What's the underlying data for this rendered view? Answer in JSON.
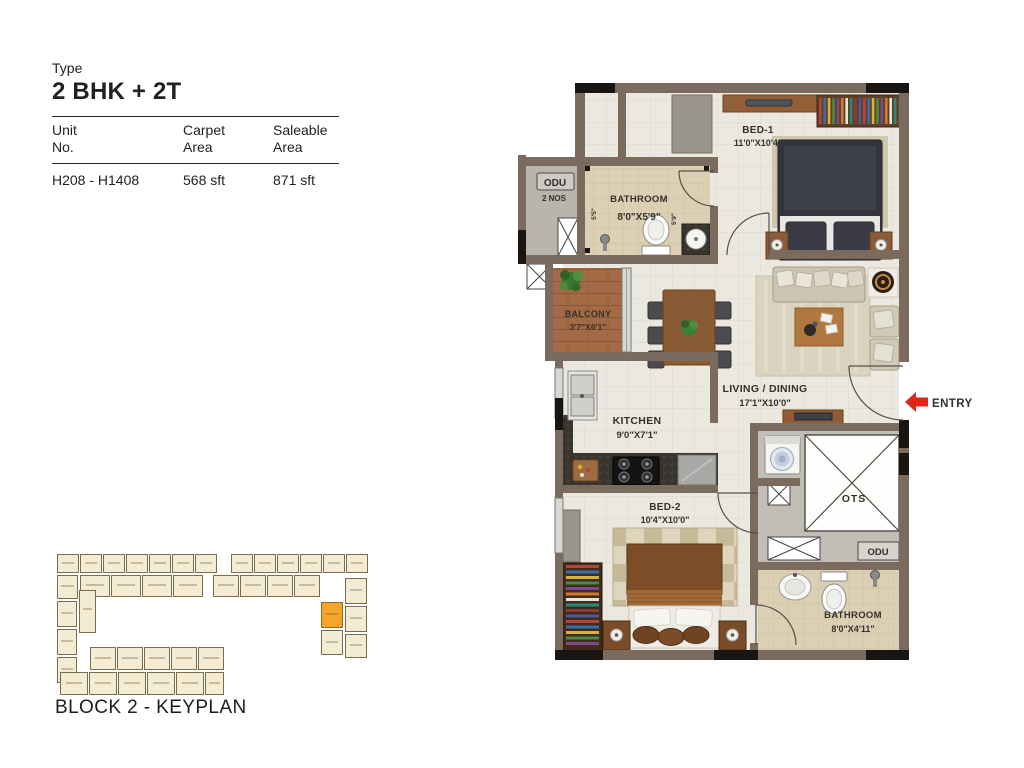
{
  "header": {
    "type_label": "Type",
    "type_value": "2 BHK + 2T",
    "table": {
      "columns": [
        {
          "line1": "Unit",
          "line2": "No."
        },
        {
          "line1": "Carpet",
          "line2": "Area"
        },
        {
          "line1": "Saleable",
          "line2": "Area"
        }
      ],
      "row": {
        "unit_no": "H208 - H1408",
        "carpet_area": "568 sft",
        "saleable_area": "871 sft"
      }
    }
  },
  "floorplan": {
    "rooms": {
      "bed1": {
        "name": "BED-1",
        "dim": "11'0\"X10'4\""
      },
      "bathroom1": {
        "name": "BATHROOM",
        "dim": "8'0\"X5'9\""
      },
      "odu_top": {
        "name": "ODU",
        "qty": "2 NOS"
      },
      "balcony": {
        "name": "BALCONY",
        "dim": "3'7\"X6'1\""
      },
      "living_dining": {
        "name": "LIVING / DINING",
        "dim": "17'1\"X10'0\""
      },
      "kitchen": {
        "name": "KITCHEN",
        "dim": "9'0\"X7'1\""
      },
      "bed2": {
        "name": "BED-2",
        "dim": "10'4\"X10'0\""
      },
      "ots": {
        "name": "OTS"
      },
      "odu_bottom": {
        "name": "ODU"
      },
      "bathroom2": {
        "name": "BATHROOM",
        "dim": "8'0\"X4'11\""
      }
    },
    "small_dims": {
      "bathroom1_left": "5'5\"",
      "bathroom1_right": "5'9\""
    },
    "entry_label": "ENTRY",
    "colors": {
      "wall": "#7b6b5e",
      "column_black": "#181512",
      "floor": "#ebe8e0",
      "bathroom_floor": "#ddcfb4",
      "balcony_floor": "#a26b45",
      "utility_floor": "#c2beb6",
      "entry_arrow_red": "#e0251b",
      "wardrobe_palette": [
        "#b5453a",
        "#3a6ea8",
        "#d8b13a",
        "#4a8a4a",
        "#7a4a8a",
        "#cf7a2e",
        "#e8e4da",
        "#2a8a7a",
        "#8a3a3a",
        "#4a5a9a"
      ]
    }
  },
  "keyplan": {
    "title": "BLOCK 2 - KEYPLAN",
    "block_color": "#f4ecd2",
    "block_border": "#7c6c4e",
    "highlight_color": "#f3a52c",
    "blocks": [
      [
        2,
        2,
        22,
        19
      ],
      [
        25,
        2,
        22,
        19
      ],
      [
        48,
        2,
        22,
        19
      ],
      [
        71,
        2,
        22,
        19
      ],
      [
        94,
        2,
        22,
        19
      ],
      [
        117,
        2,
        22,
        19
      ],
      [
        140,
        2,
        22,
        19
      ],
      [
        176,
        2,
        22,
        19
      ],
      [
        199,
        2,
        22,
        19
      ],
      [
        222,
        2,
        22,
        19
      ],
      [
        245,
        2,
        22,
        19
      ],
      [
        268,
        2,
        22,
        19
      ],
      [
        291,
        2,
        22,
        19
      ],
      [
        2,
        23,
        21,
        24
      ],
      [
        25,
        23,
        30,
        22
      ],
      [
        56,
        23,
        30,
        22
      ],
      [
        87,
        23,
        30,
        22
      ],
      [
        118,
        23,
        30,
        22
      ],
      [
        158,
        23,
        26,
        22
      ],
      [
        185,
        23,
        26,
        22
      ],
      [
        212,
        23,
        26,
        22
      ],
      [
        239,
        23,
        26,
        22
      ],
      [
        290,
        26,
        22,
        26
      ],
      [
        290,
        54,
        22,
        26
      ],
      [
        290,
        82,
        22,
        24
      ],
      [
        266,
        50,
        22,
        26,
        1
      ],
      [
        266,
        78,
        22,
        25
      ],
      [
        2,
        49,
        20,
        26
      ],
      [
        2,
        77,
        20,
        26
      ],
      [
        2,
        105,
        20,
        26
      ],
      [
        24,
        38,
        17,
        43
      ],
      [
        35,
        95,
        26,
        23
      ],
      [
        62,
        95,
        26,
        23
      ],
      [
        89,
        95,
        26,
        23
      ],
      [
        116,
        95,
        26,
        23
      ],
      [
        143,
        95,
        26,
        23
      ],
      [
        5,
        120,
        28,
        23
      ],
      [
        34,
        120,
        28,
        23
      ],
      [
        63,
        120,
        28,
        23
      ],
      [
        92,
        120,
        28,
        23
      ],
      [
        121,
        120,
        28,
        23
      ],
      [
        150,
        120,
        19,
        23
      ]
    ]
  }
}
